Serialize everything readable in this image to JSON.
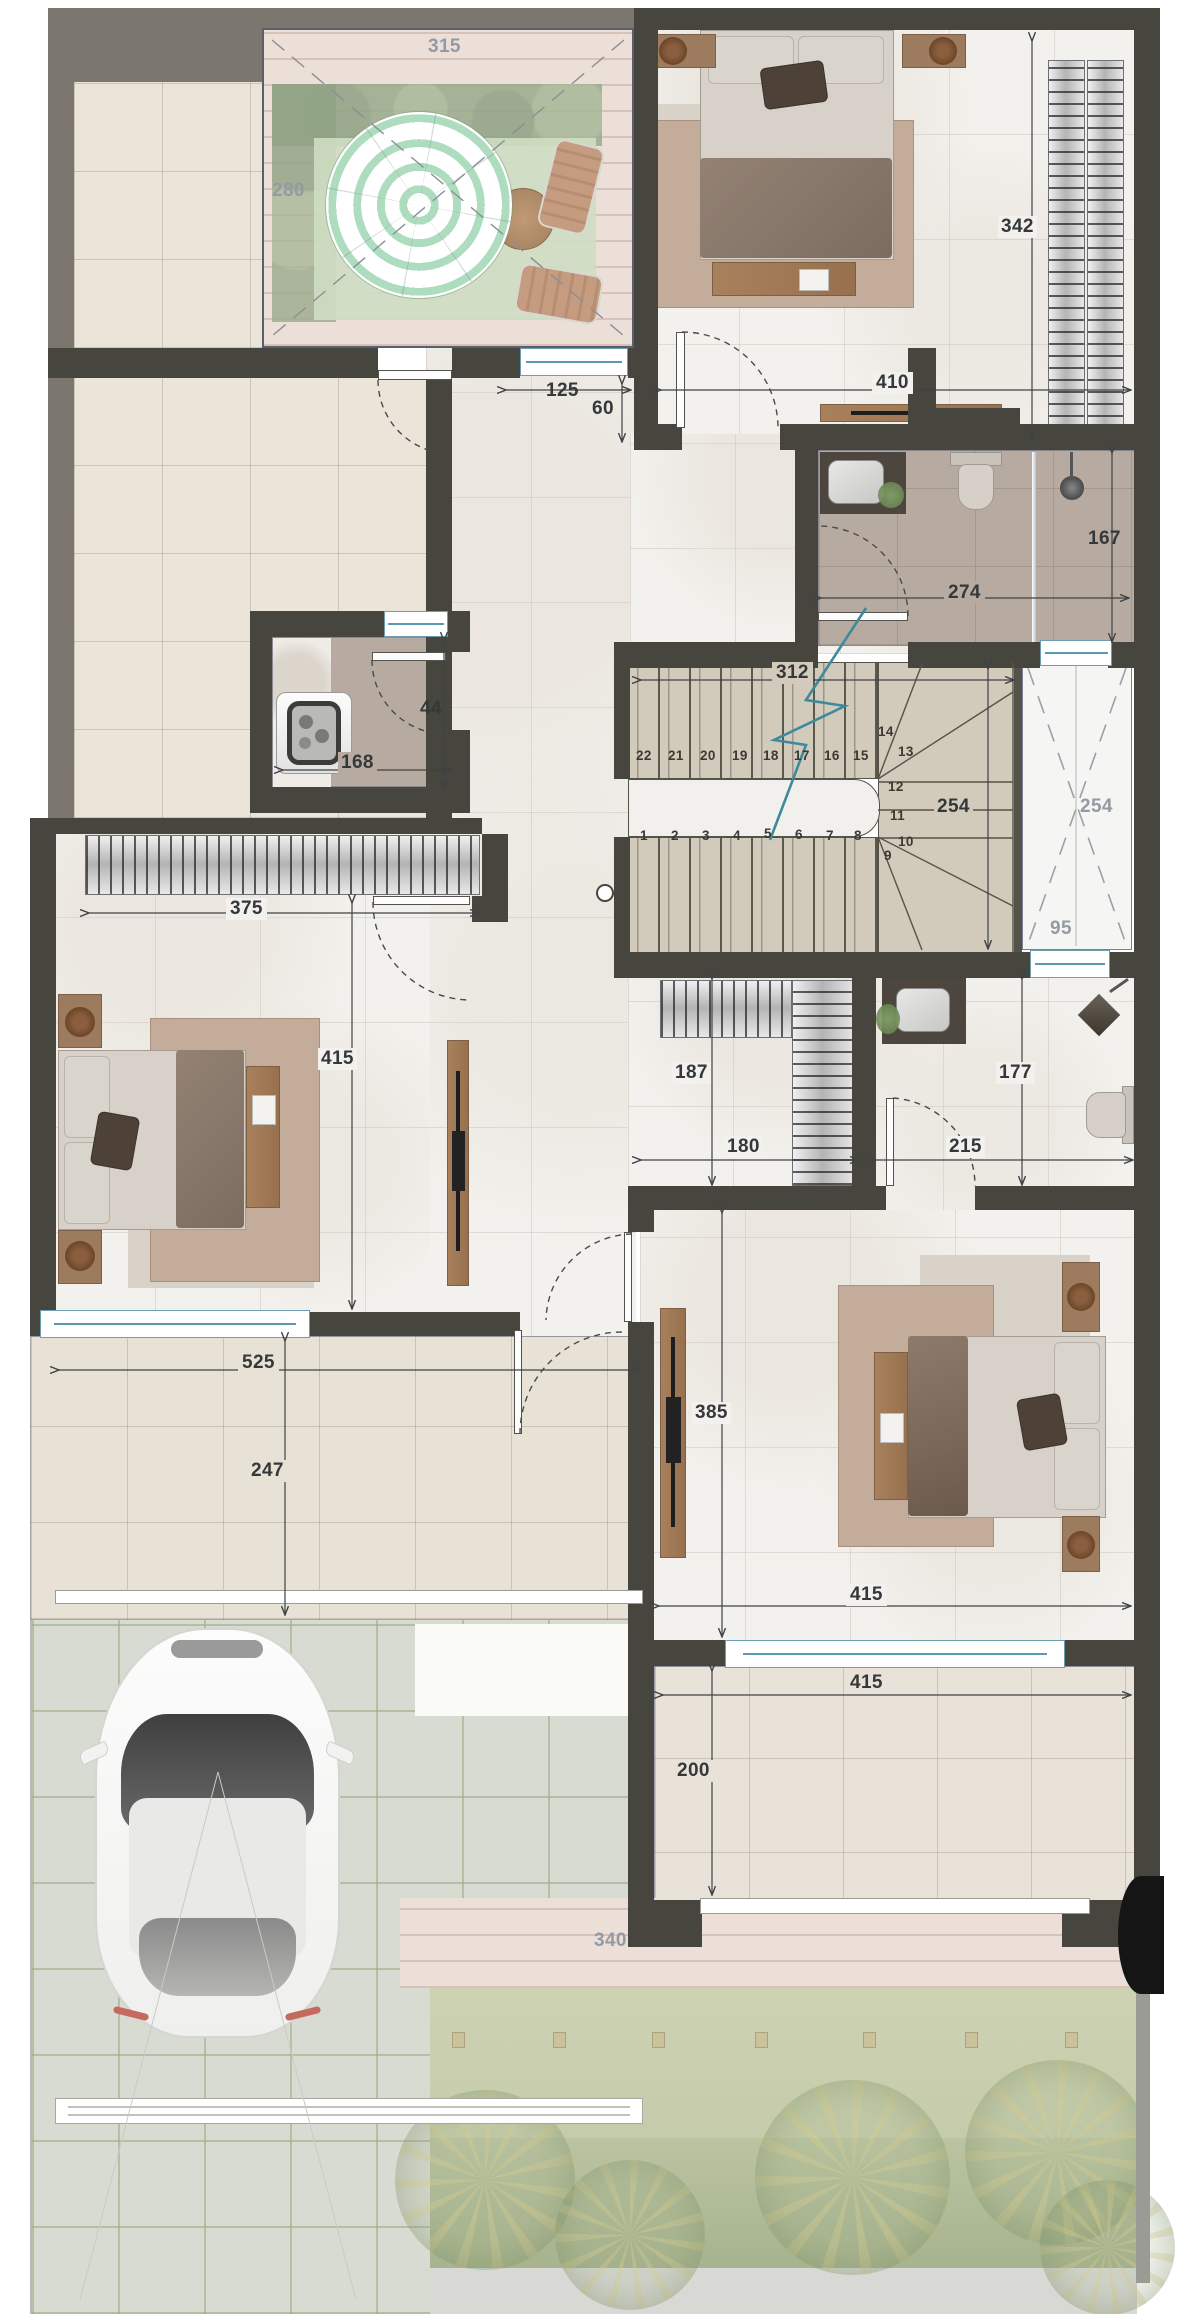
{
  "dims": {
    "patio_width": "315",
    "patio_height": "280",
    "hall_window_width": "125",
    "niche_depth": "60",
    "bed1_width": "410",
    "bed1_height": "342",
    "bath1_width": "274",
    "bath1_height": "167",
    "stairs_width": "312",
    "stairs_height": "254",
    "shaft_height": "254",
    "shaft_width": "95",
    "laundry_width": "168",
    "laundry_depth": "44",
    "wardrobe_width": "375",
    "bed2_height": "415",
    "closet_height": "187",
    "closet_width": "180",
    "bath2_height": "177",
    "bath2_width": "215",
    "porch_width": "525",
    "porch_height": "247",
    "bed3_height": "385",
    "bed3_width": "415",
    "balcony_width": "415",
    "balcony_height": "200",
    "deck_width": "340"
  },
  "stairs": {
    "steps": [
      "1",
      "2",
      "3",
      "4",
      "5",
      "6",
      "7",
      "8",
      "9",
      "10",
      "11",
      "12",
      "13",
      "14",
      "15",
      "16",
      "17",
      "18",
      "19",
      "20",
      "21",
      "22"
    ]
  },
  "colors": {
    "wall": "#46463e",
    "outer_band": "#7b776e",
    "window_teal": "#5b9ab0",
    "break_line_teal": "#3d8a9c",
    "dim_text": "#35383b",
    "dim_text_gray": "#949aa3",
    "umbrella_green": "#aedcbf"
  }
}
